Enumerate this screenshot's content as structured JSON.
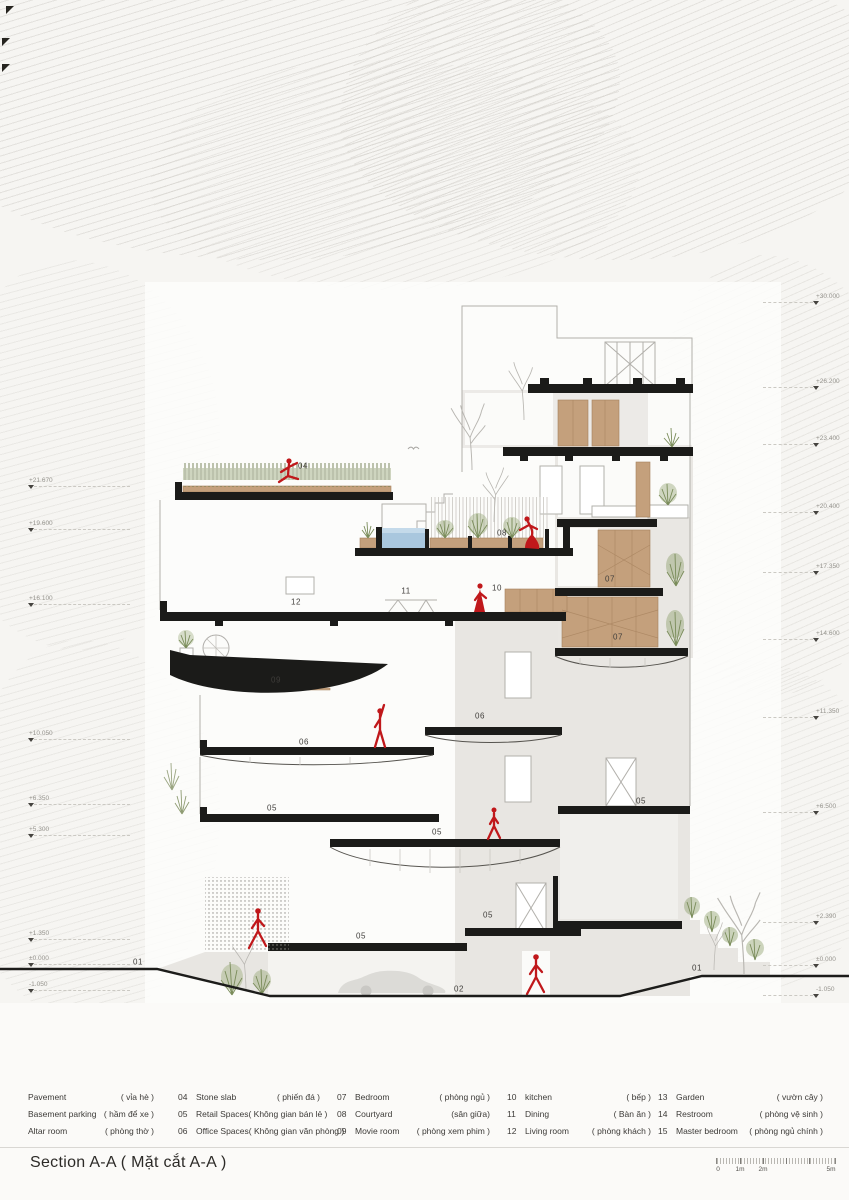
{
  "title": {
    "text": "Section A-A  ( Mặt cắt A-A )"
  },
  "colors": {
    "figure_red": "#c0181b",
    "slab_black": "#1b1b19",
    "wood": "#c4a07c",
    "water": "#a9c7de",
    "plant_green": "#7a8c5a",
    "tree_gray": "#b8b6b1",
    "mass_gray": "#e8e6e2"
  },
  "legend": {
    "columns": [
      {
        "items": [
          {
            "num": "",
            "en": "Pavement",
            "vi": "( vỉa hè )"
          },
          {
            "num": "",
            "en": "Basement parking",
            "vi": "( hầm để xe )"
          },
          {
            "num": "",
            "en": "Altar room",
            "vi": "( phòng thờ )"
          }
        ]
      },
      {
        "items": [
          {
            "num": "04",
            "en": "Stone slab",
            "vi": "( phiến đá )"
          },
          {
            "num": "05",
            "en": "Retail Spaces",
            "vi": "( Không gian bán lẻ )"
          },
          {
            "num": "06",
            "en": "Office Spaces",
            "vi": "( Không gian văn phòng )"
          }
        ]
      },
      {
        "items": [
          {
            "num": "07",
            "en": "Bedroom",
            "vi": "( phòng ngủ )"
          },
          {
            "num": "08",
            "en": "Courtyard",
            "vi": "(sân giữa)"
          },
          {
            "num": "09",
            "en": "Movie room",
            "vi": "( phòng xem phim )"
          }
        ]
      },
      {
        "items": [
          {
            "num": "10",
            "en": "kitchen",
            "vi": "( bếp )"
          },
          {
            "num": "11",
            "en": "Dining",
            "vi": "( Bàn ăn )"
          },
          {
            "num": "12",
            "en": "Living room",
            "vi": "( phòng khách )"
          }
        ]
      },
      {
        "items": [
          {
            "num": "13",
            "en": "Garden",
            "vi": "( vườn cây )"
          },
          {
            "num": "14",
            "en": "Restroom",
            "vi": "( phòng vệ sinh )"
          },
          {
            "num": "15",
            "en": "Master bedroom",
            "vi": "( phòng ngủ chính )"
          }
        ]
      }
    ]
  },
  "scalebar": {
    "labels": [
      "0",
      "1m",
      "2m",
      "5m"
    ]
  },
  "elevations": {
    "left": [
      {
        "value": "+21.670"
      },
      {
        "value": "+19.600"
      },
      {
        "value": "+16.100"
      },
      {
        "value": "+10.050"
      },
      {
        "value": "+6.350"
      },
      {
        "value": "+5.300"
      },
      {
        "value": "+1.350"
      },
      {
        "value": "±0.000"
      },
      {
        "value": "-1.050"
      }
    ],
    "right": [
      {
        "value": "+30.000"
      },
      {
        "value": "+26.200"
      },
      {
        "value": "+23.400"
      },
      {
        "value": "+20.400"
      },
      {
        "value": "+17.350"
      },
      {
        "value": "+14.600"
      },
      {
        "value": "+11.350"
      },
      {
        "value": "+6.500"
      },
      {
        "value": "+2.390"
      },
      {
        "value": "±0.000"
      },
      {
        "value": "-1.050"
      }
    ]
  },
  "room_labels": [
    {
      "num": "04"
    },
    {
      "num": "08"
    },
    {
      "num": "12"
    },
    {
      "num": "11"
    },
    {
      "num": "10"
    },
    {
      "num": "07"
    },
    {
      "num": "07"
    },
    {
      "num": "09"
    },
    {
      "num": "06"
    },
    {
      "num": "06"
    },
    {
      "num": "05"
    },
    {
      "num": "05"
    },
    {
      "num": "05"
    },
    {
      "num": "05"
    },
    {
      "num": "05"
    },
    {
      "num": "01"
    },
    {
      "num": "01"
    },
    {
      "num": "02"
    }
  ]
}
